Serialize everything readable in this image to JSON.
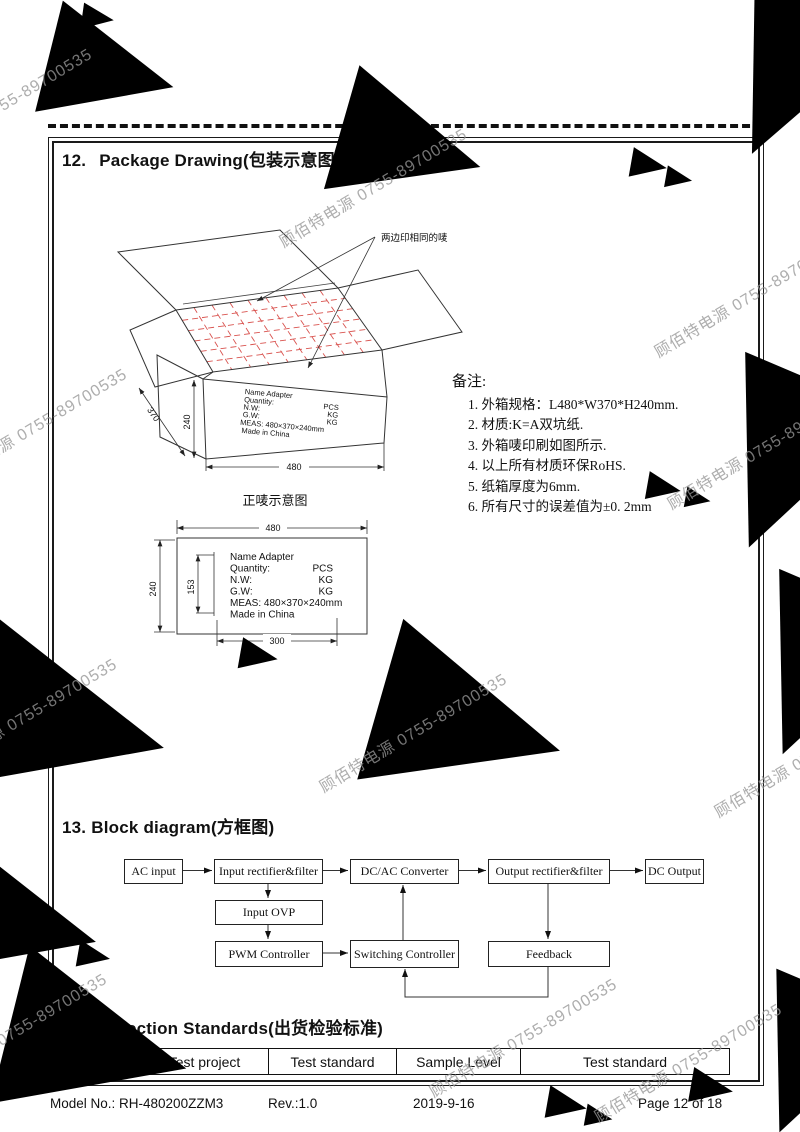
{
  "watermark": {
    "text": "顾佰特电源 0755-89700535"
  },
  "colors": {
    "grid_red": "#d9534f",
    "watermark_gray": "#bdbdbd",
    "ink": "#111111"
  },
  "package_section": {
    "number": "12.",
    "title": "Package Drawing(包装示意图)",
    "callout": "两边印相同的唛",
    "front_mark_title": "正唛示意图",
    "carton_dims": {
      "length": "480",
      "width": "370",
      "height": "240"
    },
    "front_mark_dims": {
      "width": "480",
      "height": "240",
      "label_height": "153",
      "label_width": "300"
    },
    "notes_title": "备注:",
    "notes": [
      "1. 外箱规格：L480*W370*H240mm.",
      "2. 材质:K=A双坑纸.",
      "3. 外箱唛印刷如图所示.",
      "4. 以上所有材质环保RoHS.",
      "5. 纸箱厚度为6mm.",
      "6. 所有尺寸的误差值为±0. 2mm"
    ]
  },
  "shipping_label": {
    "name": "Name Adapter",
    "rows": [
      [
        "Quantity:",
        "PCS"
      ],
      [
        "N.W:",
        "KG"
      ],
      [
        "G.W:",
        "KG"
      ]
    ],
    "meas": "MEAS: 480×370×240mm",
    "origin": "Made in China"
  },
  "block_section": {
    "number": "13.",
    "title": "Block diagram(方框图)",
    "blocks": {
      "ac_input": "AC input",
      "input_rectifier": "Input rectifier&filter",
      "dcac_converter": "DC/AC Converter",
      "output_rectifier": "Output rectifier&filter",
      "dc_output": "DC Output",
      "input_ovp": "Input OVP",
      "pwm": "PWM Controller",
      "switching": "Switching Controller",
      "feedback": "Feedback"
    }
  },
  "inspection_section": {
    "number": "14.",
    "title": "Inspection Standards(出货检验标准)",
    "headers": [
      "NO.",
      "Test project",
      "Test standard",
      "Sample Level",
      "Test standard"
    ]
  },
  "footer": {
    "model": "Model No.: RH-480200ZZM3",
    "rev": "Rev.:1.0",
    "date": "2019-9-16",
    "page": "Page 12 of 18"
  }
}
